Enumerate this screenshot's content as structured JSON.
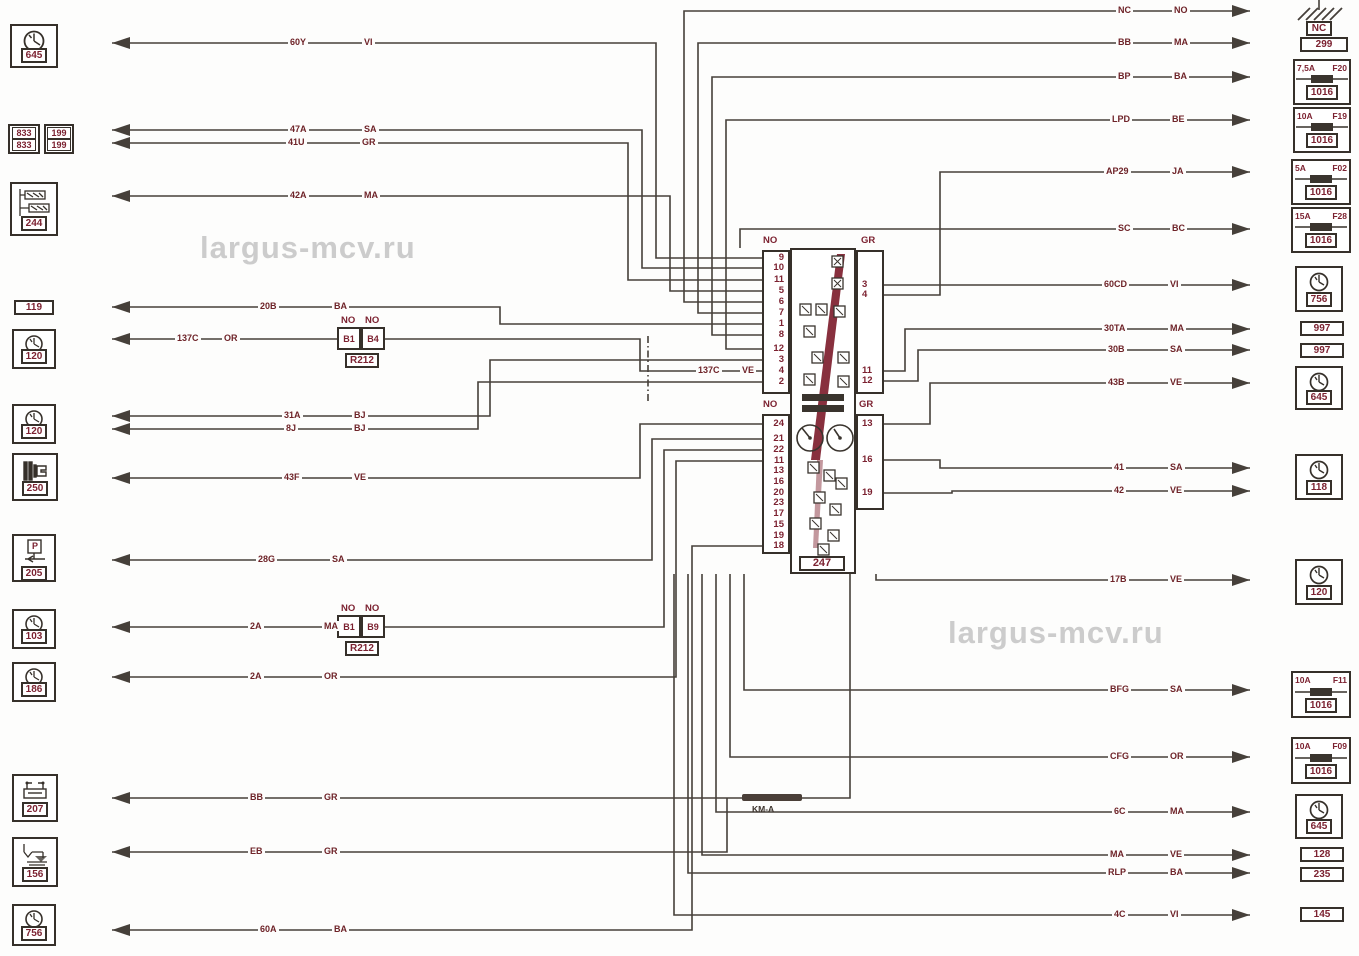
{
  "watermarks": {
    "left": "largus-mcv.ru",
    "right": "largus-mcv.ru"
  },
  "cluster": {
    "id": "247",
    "connectors": {
      "top_left": {
        "label": "NO",
        "pins": [
          "9",
          "10",
          "11",
          "5",
          "6",
          "7",
          "1",
          "8",
          "12",
          "3",
          "4",
          "2"
        ]
      },
      "top_right": {
        "label": "GR",
        "pins": [
          "3",
          "4",
          "11",
          "12"
        ]
      },
      "bottom_left": {
        "label": "NO",
        "pins": [
          "24",
          "21",
          "22",
          "11",
          "13",
          "16",
          "20",
          "23",
          "17",
          "15",
          "19",
          "18"
        ]
      },
      "bottom_right": {
        "label": "GR",
        "pins": [
          "13",
          "16",
          "19"
        ]
      }
    }
  },
  "ground": {
    "label": "NC"
  },
  "inline_connectors": [
    {
      "id": "R212",
      "top_labels": [
        "NO",
        "NO"
      ],
      "pins": [
        "B1",
        "B4"
      ]
    },
    {
      "id": "R212",
      "top_labels": [
        "NO",
        "NO"
      ],
      "pins": [
        "B1",
        "B9"
      ]
    }
  ],
  "splice": {
    "label": "KM-A"
  },
  "icons": {
    "parking_label": "P"
  },
  "left_components": [
    {
      "id": "645",
      "icon": "clock-icon"
    },
    {
      "id": "244",
      "icon": "heater-resistor-icon"
    },
    {
      "id": "119"
    },
    {
      "id": "120",
      "icon": "clock-icon"
    },
    {
      "id": "120",
      "icon": "clock-icon"
    },
    {
      "id": "250",
      "icon": "speed-sensor-icon"
    },
    {
      "id": "205",
      "icon": "parking-brake-icon"
    },
    {
      "id": "103",
      "icon": "clock-icon"
    },
    {
      "id": "186",
      "icon": "clock-icon"
    },
    {
      "id": "207",
      "icon": "relay-icon"
    },
    {
      "id": "156",
      "icon": "fuel-sender-icon"
    },
    {
      "id": "756",
      "icon": "clock-icon"
    }
  ],
  "left_multi_boxes": {
    "a": [
      "833",
      "833"
    ],
    "b": [
      "199",
      "199"
    ]
  },
  "right_components": [
    {
      "id": "299"
    },
    {
      "amp": "7,5A",
      "fuse": "F20",
      "id": "1016"
    },
    {
      "amp": "10A",
      "fuse": "F19",
      "id": "1016"
    },
    {
      "amp": "5A",
      "fuse": "F02",
      "id": "1016"
    },
    {
      "amp": "15A",
      "fuse": "F28",
      "id": "1016"
    },
    {
      "id": "756",
      "icon": "clock-icon"
    },
    {
      "id": "997"
    },
    {
      "id": "997"
    },
    {
      "id": "645",
      "icon": "clock-icon"
    },
    {
      "id": "118",
      "icon": "clock-icon"
    },
    {
      "id": "120",
      "icon": "clock-icon"
    },
    {
      "amp": "10A",
      "fuse": "F11",
      "id": "1016"
    },
    {
      "amp": "10A",
      "fuse": "F09",
      "id": "1016"
    },
    {
      "id": "645",
      "icon": "clock-icon"
    },
    {
      "id": "128"
    },
    {
      "id": "235"
    },
    {
      "id": "145"
    }
  ],
  "left_wires": [
    {
      "num": "60Y",
      "color": "VI"
    },
    {
      "num": "47A",
      "color": "SA"
    },
    {
      "num": "41U",
      "color": "GR"
    },
    {
      "num": "42A",
      "color": "MA"
    },
    {
      "num": "20B",
      "color": "BA"
    },
    {
      "num": "137C",
      "color": "OR"
    },
    {
      "num": "137C",
      "color": "VE"
    },
    {
      "num": "31A",
      "color": "BJ"
    },
    {
      "num": "8J",
      "color": "BJ"
    },
    {
      "num": "43F",
      "color": "VE"
    },
    {
      "num": "28G",
      "color": "SA"
    },
    {
      "num": "2A",
      "color": "MA"
    },
    {
      "num": "2A",
      "color": "OR"
    },
    {
      "num": "BB",
      "color": "GR"
    },
    {
      "num": "EB",
      "color": "GR"
    },
    {
      "num": "60A",
      "color": "BA"
    }
  ],
  "right_wires": [
    {
      "num": "NC",
      "color": "NO"
    },
    {
      "num": "BB",
      "color": "MA"
    },
    {
      "num": "BP",
      "color": "BA"
    },
    {
      "num": "LPD",
      "color": "BE"
    },
    {
      "num": "AP29",
      "color": "JA"
    },
    {
      "num": "SC",
      "color": "BC"
    },
    {
      "num": "60CD",
      "color": "VI"
    },
    {
      "num": "30TA",
      "color": "MA"
    },
    {
      "num": "30B",
      "color": "SA"
    },
    {
      "num": "43B",
      "color": "VE"
    },
    {
      "num": "41",
      "color": "SA"
    },
    {
      "num": "42",
      "color": "VE"
    },
    {
      "num": "17B",
      "color": "VE"
    },
    {
      "num": "BFG",
      "color": "SA"
    },
    {
      "num": "CFG",
      "color": "OR"
    },
    {
      "num": "6C",
      "color": "MA"
    },
    {
      "num": "MA",
      "color": "VE"
    },
    {
      "num": "RLP",
      "color": "BA"
    },
    {
      "num": "4C",
      "color": "VI"
    }
  ]
}
